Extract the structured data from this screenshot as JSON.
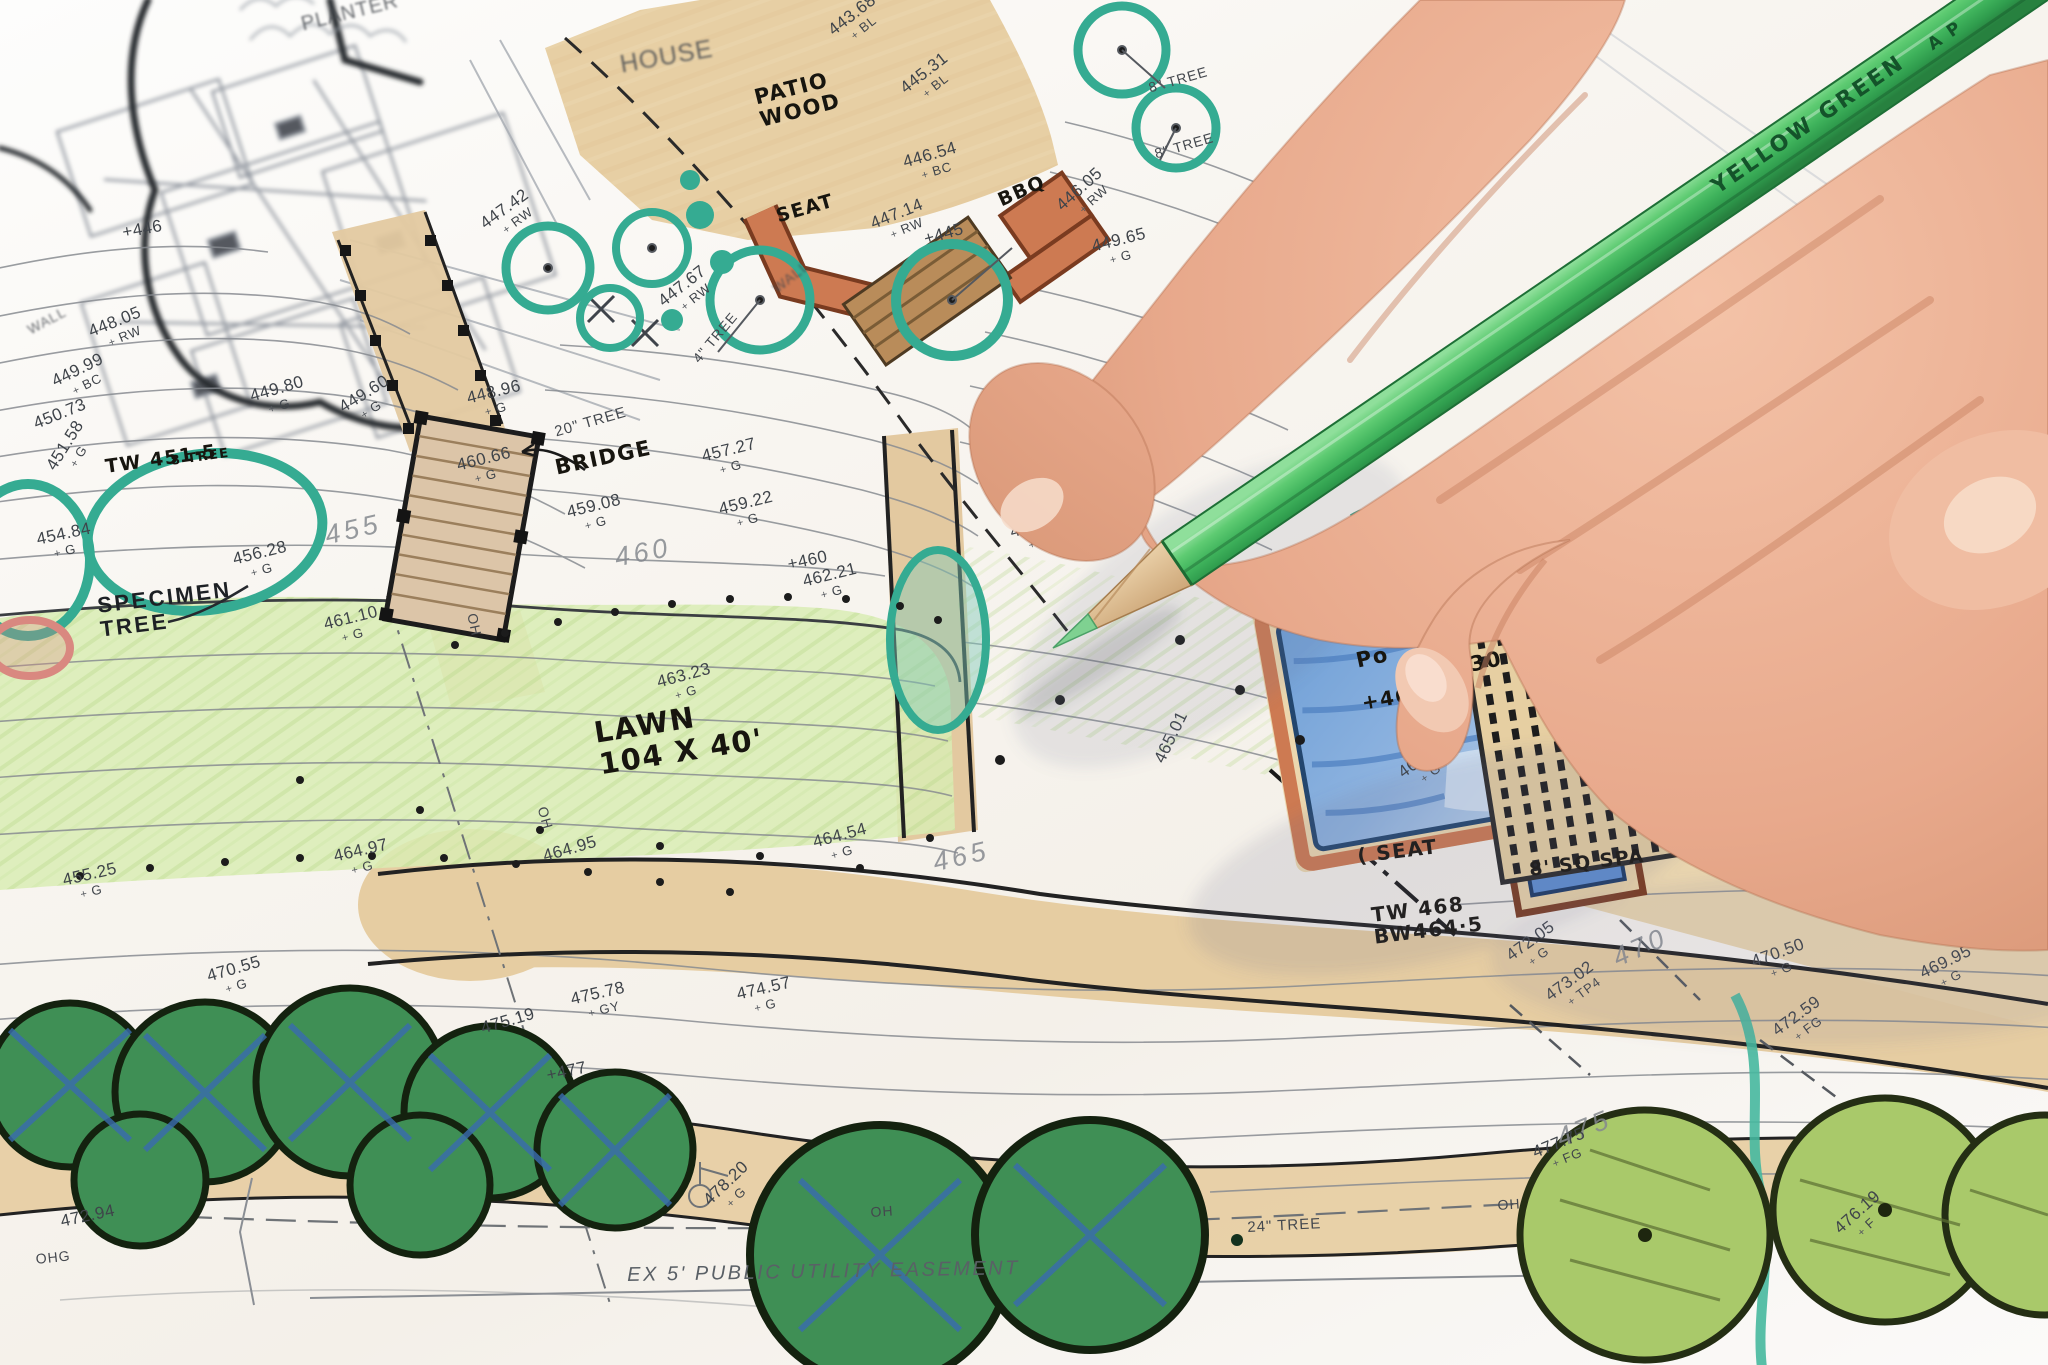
{
  "pencil": {
    "label": "YELLOW GREEN",
    "stamp": "A P",
    "color": "#4fbf68"
  },
  "plan": {
    "colors": {
      "teal_marker": "#3aae95",
      "lawn_green": "#cfe6a4",
      "pool_blue": "#7aa3d6",
      "tan_path": "#e6cda2",
      "hedge_green": "#3f8f55",
      "light_tree_green": "#a9c96a",
      "wall_orange": "#cd7a52",
      "skin": "#e9ae93"
    },
    "labels": [
      {
        "t": "PLANTER",
        "x": 14.6,
        "y": 1.0,
        "r": -14,
        "fs": 20,
        "cls": "printed faint"
      },
      {
        "t": "HOUSE",
        "x": 30.2,
        "y": 3.8,
        "r": -10,
        "fs": 25,
        "cls": "printed faint"
      },
      {
        "t": "PATIO\nWOOD",
        "x": 36.7,
        "y": 6.4,
        "r": -14,
        "fs": 21,
        "cls": "hand"
      },
      {
        "t": "SEAT",
        "x": 37.8,
        "y": 15.2,
        "r": -16,
        "fs": 19,
        "cls": "hand"
      },
      {
        "t": "WALL",
        "x": 37.6,
        "y": 20.8,
        "r": -38,
        "fs": 14,
        "cls": "printed faint"
      },
      {
        "t": "BBQ",
        "x": 48.6,
        "y": 14.1,
        "r": -24,
        "fs": 19,
        "cls": "hand"
      },
      {
        "t": "WALL",
        "x": 1.2,
        "y": 23.7,
        "r": -28,
        "fs": 14,
        "cls": "printed faint"
      },
      {
        "t": "8\" TREE",
        "x": 56.0,
        "y": 5.9,
        "r": -16,
        "fs": 14,
        "cls": "printed"
      },
      {
        "t": "8\" TREE",
        "x": 56.3,
        "y": 10.8,
        "r": -16,
        "fs": 14,
        "cls": "printed"
      },
      {
        "t": "4\" TREE",
        "x": 33.7,
        "y": 26.1,
        "r": -50,
        "fs": 14,
        "cls": "printed"
      },
      {
        "t": "20\" TREE",
        "x": 27.0,
        "y": 31.1,
        "r": -16,
        "fs": 15,
        "cls": "printed"
      },
      {
        "t": "BRIDGE",
        "x": 27.0,
        "y": 33.5,
        "r": -12,
        "fs": 21,
        "cls": "hand"
      },
      {
        "t": "TW 451·5",
        "x": 5.1,
        "y": 33.5,
        "r": -8,
        "fs": 19,
        "cls": "hand"
      },
      {
        "t": "8 TREE",
        "x": 8.3,
        "y": 33.3,
        "r": -8,
        "fs": 13,
        "cls": "hand"
      },
      {
        "t": "SPECIMEN\nTREE",
        "x": 4.7,
        "y": 43.5,
        "r": -7,
        "fs": 22,
        "cls": "printed dark"
      },
      {
        "t": "LAWN\n104 X 40'",
        "x": 28.9,
        "y": 52.6,
        "r": -9,
        "fs": 29,
        "cls": "hand"
      },
      {
        "t": "Po",
        "x": 66.1,
        "y": 47.6,
        "r": -12,
        "fs": 21,
        "cls": "hand"
      },
      {
        "t": "30",
        "x": 71.7,
        "y": 47.9,
        "r": -12,
        "fs": 21,
        "cls": "hand"
      },
      {
        "t": "+46",
        "x": 66.4,
        "y": 50.7,
        "r": -10,
        "fs": 20,
        "cls": "hand"
      },
      {
        "t": "+462·5",
        "x": 76.7,
        "y": 48.0,
        "r": -12,
        "fs": 20,
        "cls": "hand"
      },
      {
        "t": "TRELLIS\n20X10",
        "x": 81.6,
        "y": 53.0,
        "r": -8,
        "fs": 20,
        "cls": "hand"
      },
      {
        "t": "( SEAT",
        "x": 66.2,
        "y": 61.9,
        "r": -7,
        "fs": 20,
        "cls": "hand"
      },
      {
        "t": "8' SQ SPA",
        "x": 74.6,
        "y": 63.0,
        "r": -7,
        "fs": 19,
        "cls": "hand"
      },
      {
        "t": "TW 468\nBW464·5",
        "x": 66.9,
        "y": 66.2,
        "r": -7,
        "fs": 20,
        "cls": "hand"
      },
      {
        "t": "24\" TREE",
        "x": 60.9,
        "y": 89.4,
        "r": -3,
        "fs": 15,
        "cls": "printed"
      },
      {
        "t": "EX 5' PUBLIC UTILITY EASEMENT",
        "x": 30.6,
        "y": 92.6,
        "r": -1,
        "fs": 20,
        "cls": "printed easement"
      },
      {
        "t": "OH",
        "x": 23.4,
        "y": 44.8,
        "r": 78,
        "fs": 14,
        "cls": "printed"
      },
      {
        "t": "OH",
        "x": 26.8,
        "y": 59.0,
        "r": 74,
        "fs": 14,
        "cls": "printed"
      },
      {
        "t": "OH",
        "x": 42.5,
        "y": 88.3,
        "r": -4,
        "fs": 14,
        "cls": "printed"
      },
      {
        "t": "OH",
        "x": 73.1,
        "y": 87.8,
        "r": -4,
        "fs": 14,
        "cls": "printed"
      },
      {
        "t": "OHG",
        "x": 1.7,
        "y": 91.7,
        "r": -6,
        "fs": 14,
        "cls": "printed"
      },
      {
        "t": "55 PG",
        "x": 76.3,
        "y": 2.2,
        "r": -54,
        "fs": 19,
        "cls": "printed faint"
      }
    ],
    "spot_elevations": [
      {
        "v": "+446",
        "s": "",
        "x": 5.9,
        "y": 16.4,
        "r": -10
      },
      {
        "v": "447.42",
        "s": "RW",
        "x": 23.3,
        "y": 16.0,
        "r": -36
      },
      {
        "v": "443.68",
        "s": "BL",
        "x": 40.3,
        "y": 1.8,
        "r": -38
      },
      {
        "v": "445.31",
        "s": "BL",
        "x": 43.8,
        "y": 6.1,
        "r": -38
      },
      {
        "v": "446.54",
        "s": "BC",
        "x": 44.0,
        "y": 11.3,
        "r": -16
      },
      {
        "v": "447.14",
        "s": "RW",
        "x": 42.4,
        "y": 15.8,
        "r": -22
      },
      {
        "v": "+445",
        "s": "",
        "x": 45.0,
        "y": 16.9,
        "r": -16
      },
      {
        "v": "446.05",
        "s": "RW",
        "x": 51.4,
        "y": 14.7,
        "r": -42
      },
      {
        "v": "449.65",
        "s": "G",
        "x": 53.2,
        "y": 17.4,
        "r": -14
      },
      {
        "v": "447.67",
        "s": "RW",
        "x": 32.0,
        "y": 21.7,
        "r": -38
      },
      {
        "v": "448.05",
        "s": "RW",
        "x": 4.2,
        "y": 23.7,
        "r": -22
      },
      {
        "v": "449.99",
        "s": "BC",
        "x": 2.4,
        "y": 27.4,
        "r": -26
      },
      {
        "v": "450.73",
        "s": "",
        "x": 1.5,
        "y": 30.5,
        "r": -22
      },
      {
        "v": "449.80",
        "s": "G",
        "x": 12.1,
        "y": 28.4,
        "r": -16
      },
      {
        "v": "449.60",
        "s": "G",
        "x": 16.4,
        "y": 29.4,
        "r": -32
      },
      {
        "v": "448.96",
        "s": "G",
        "x": 22.7,
        "y": 28.6,
        "r": -14
      },
      {
        "v": "451.58",
        "s": "G",
        "x": 2.1,
        "y": 34.0,
        "r": -58
      },
      {
        "v": "454.84",
        "s": "G",
        "x": 1.7,
        "y": 38.9,
        "r": -12
      },
      {
        "v": "456.28",
        "s": "G",
        "x": 11.3,
        "y": 40.4,
        "r": -14
      },
      {
        "v": "460.66",
        "s": "G",
        "x": 22.2,
        "y": 33.5,
        "r": -14
      },
      {
        "v": "459.08",
        "s": "G",
        "x": 27.6,
        "y": 36.9,
        "r": -14
      },
      {
        "v": "459.22",
        "s": "G",
        "x": 35.0,
        "y": 36.7,
        "r": -14
      },
      {
        "v": "457.27",
        "s": "G",
        "x": 34.2,
        "y": 32.8,
        "r": -14
      },
      {
        "v": "457.27",
        "s": "G",
        "x": 53.6,
        "y": 32.7,
        "r": -14
      },
      {
        "v": "461.10",
        "s": "G",
        "x": 15.7,
        "y": 45.1,
        "r": -14
      },
      {
        "v": "+460",
        "s": "",
        "x": 38.4,
        "y": 40.7,
        "r": -12
      },
      {
        "v": "462.21",
        "s": "G",
        "x": 39.1,
        "y": 42.0,
        "r": -14
      },
      {
        "v": "460.85",
        "s": "G",
        "x": 49.2,
        "y": 38.4,
        "r": -16
      },
      {
        "v": "463.23",
        "s": "G",
        "x": 32.0,
        "y": 49.4,
        "r": -15
      },
      {
        "v": "464.54",
        "s": "G",
        "x": 39.6,
        "y": 61.1,
        "r": -15
      },
      {
        "v": "464.95",
        "s": "",
        "x": 26.4,
        "y": 62.1,
        "r": -16
      },
      {
        "v": "464.97",
        "s": "G",
        "x": 16.2,
        "y": 62.1,
        "r": -13
      },
      {
        "v": "455.25",
        "s": "G",
        "x": 3.0,
        "y": 63.9,
        "r": -13
      },
      {
        "v": "465.01",
        "s": "",
        "x": 56.2,
        "y": 55.5,
        "r": -64
      },
      {
        "v": "463.71",
        "s": "G",
        "x": 68.1,
        "y": 56.2,
        "r": -36
      },
      {
        "v": "470.55",
        "s": "G",
        "x": 10.0,
        "y": 70.9,
        "r": -16
      },
      {
        "v": "475.19",
        "s": "",
        "x": 23.4,
        "y": 74.7,
        "r": -16
      },
      {
        "v": "475.78",
        "s": "GY",
        "x": 27.8,
        "y": 72.6,
        "r": -13
      },
      {
        "v": "474.57",
        "s": "G",
        "x": 35.9,
        "y": 72.2,
        "r": -13
      },
      {
        "v": "+477",
        "s": "",
        "x": 26.6,
        "y": 78.2,
        "r": -12
      },
      {
        "v": "478.20",
        "s": "G",
        "x": 34.2,
        "y": 87.6,
        "r": -44
      },
      {
        "v": "472.94",
        "s": "",
        "x": 2.9,
        "y": 88.9,
        "r": -12
      },
      {
        "v": "472.05",
        "s": "G",
        "x": 73.4,
        "y": 69.6,
        "r": -36
      },
      {
        "v": "473.02",
        "s": "TP4",
        "x": 75.3,
        "y": 72.5,
        "r": -36
      },
      {
        "v": "472.59",
        "s": "FG",
        "x": 86.4,
        "y": 75.1,
        "r": -36
      },
      {
        "v": "470.50",
        "s": "G",
        "x": 85.4,
        "y": 69.9,
        "r": -20
      },
      {
        "v": "469.95",
        "s": "G",
        "x": 93.6,
        "y": 70.8,
        "r": -26
      },
      {
        "v": "477.75",
        "s": "FG",
        "x": 74.7,
        "y": 83.9,
        "r": -22
      },
      {
        "v": "476.19",
        "s": "F",
        "x": 89.4,
        "y": 89.7,
        "r": -42
      }
    ],
    "contour_labels": [
      {
        "t": "455",
        "x": 15.7,
        "y": 38.2,
        "r": -13
      },
      {
        "t": "460",
        "x": 29.9,
        "y": 39.8,
        "r": -11
      },
      {
        "t": "465",
        "x": 45.4,
        "y": 62.1,
        "r": -13
      },
      {
        "t": "470",
        "x": 78.5,
        "y": 69.2,
        "r": -24
      },
      {
        "t": "475",
        "x": 75.8,
        "y": 82.4,
        "r": -22
      }
    ]
  }
}
